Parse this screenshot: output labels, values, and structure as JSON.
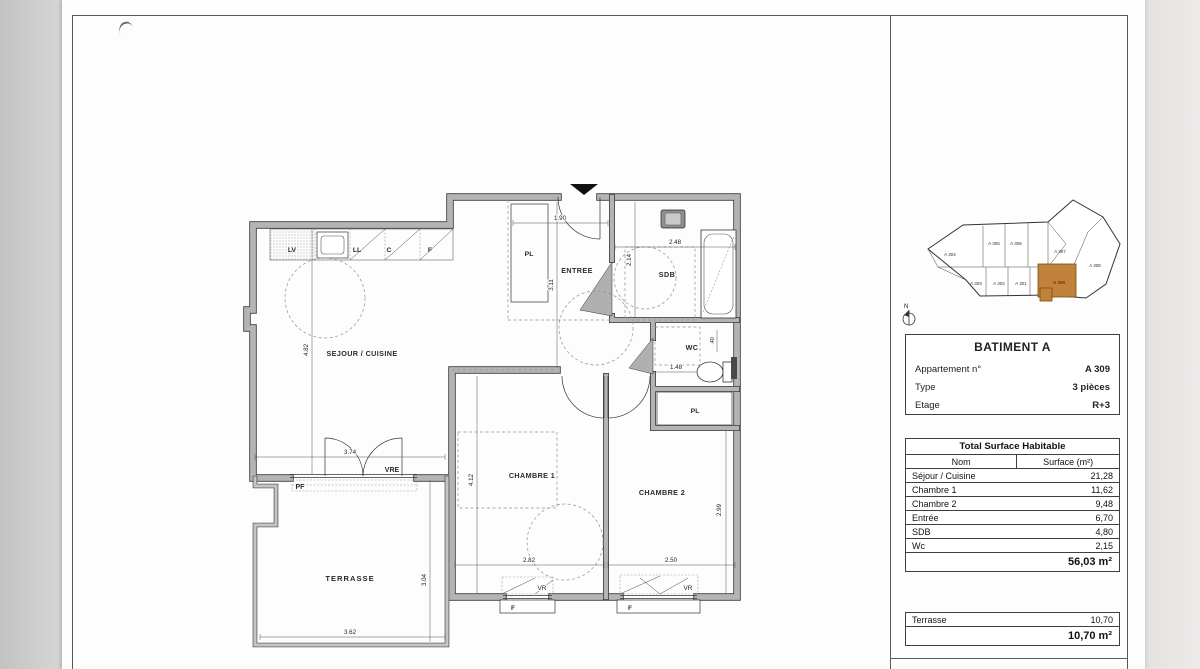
{
  "plan": {
    "rooms": {
      "sejour": "SEJOUR / CUISINE",
      "entree": "ENTREE",
      "sdb": "SDB",
      "wc": "WC",
      "pl_entree": "PL",
      "pl_chambre": "PL",
      "chambre1": "CHAMBRE 1",
      "chambre2": "CHAMBRE 2",
      "terrasse": "TERRASSE"
    },
    "kitchen": {
      "lv": "LV",
      "ll": "LL",
      "c": "C",
      "f": "F"
    },
    "labels": {
      "vre": "VRE",
      "pf": "PF",
      "vr1": "VR",
      "vr2": "VR",
      "f1": "F",
      "f2": "F"
    },
    "dims": {
      "entree_w": "1.90",
      "entree_h": "3.11",
      "sdb_w": "2.48",
      "sdb_h": "2.14",
      "sejour_h": "4.82",
      "sejour_w": "3.74",
      "wc_w": "1.48",
      "wc_h": ".40",
      "chambre1_h": "4.12",
      "chambre1_w": "2.82",
      "chambre2_w": "2.50",
      "chambre2_h": "2.99",
      "terrasse_h": "3.04",
      "terrasse_w": "3.62"
    }
  },
  "minimap": {
    "units": [
      "A 304",
      "A 305",
      "A 306",
      "A 307",
      "A 308",
      "A 303",
      "A 302",
      "A 301"
    ],
    "highlighted_unit": "A 309",
    "north_label": "N",
    "highlight_color": "#c1833c"
  },
  "panel": {
    "building_title": "BATIMENT A",
    "fields": [
      {
        "label": "Appartement n°",
        "value": "A 309"
      },
      {
        "label": "Type",
        "value": "3 pièces"
      },
      {
        "label": "Etage",
        "value": "R+3"
      }
    ],
    "surface_table": {
      "title": "Total Surface Habitable",
      "columns": {
        "name": "Nom",
        "surface": "Surface (m²)"
      },
      "rows": [
        {
          "name": "Séjour / Cuisine",
          "surface": "21,28"
        },
        {
          "name": "Chambre 1",
          "surface": "11,62"
        },
        {
          "name": "Chambre 2",
          "surface": "9,48"
        },
        {
          "name": "Entrée",
          "surface": "6,70"
        },
        {
          "name": "SDB",
          "surface": "4,80"
        },
        {
          "name": "Wc",
          "surface": "2,15"
        }
      ],
      "total": "56,03 m²"
    },
    "terrace_table": {
      "rows": [
        {
          "name": "Terrasse",
          "surface": "10,70"
        }
      ],
      "total": "10,70 m²"
    }
  }
}
